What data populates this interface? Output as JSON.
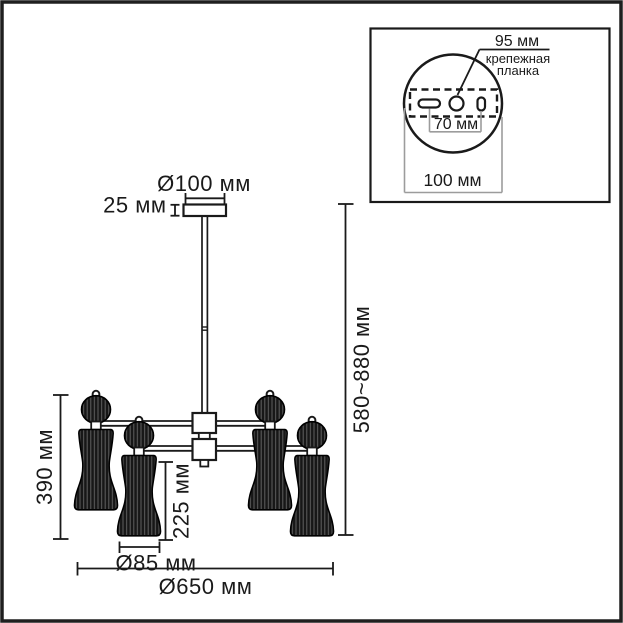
{
  "colors": {
    "ink": "#1a1a1a",
    "dim_line_gray": "#9c9c9c",
    "background": "#ffffff"
  },
  "dimensions": {
    "canopy_diameter": "Ø100 мм",
    "canopy_height": "25 мм",
    "hanging_height": "580~880 мм",
    "fixture_height": "390 мм",
    "shade_height": "225 мм",
    "shade_diameter": "Ø85 мм",
    "overall_diameter": "Ø650 мм"
  },
  "inset": {
    "hole_dimension": "95 мм",
    "plate_label_line1": "крепежная",
    "plate_label_line2": "планка",
    "slot_spacing": "70 мм",
    "canopy_diameter": "100 мм"
  }
}
